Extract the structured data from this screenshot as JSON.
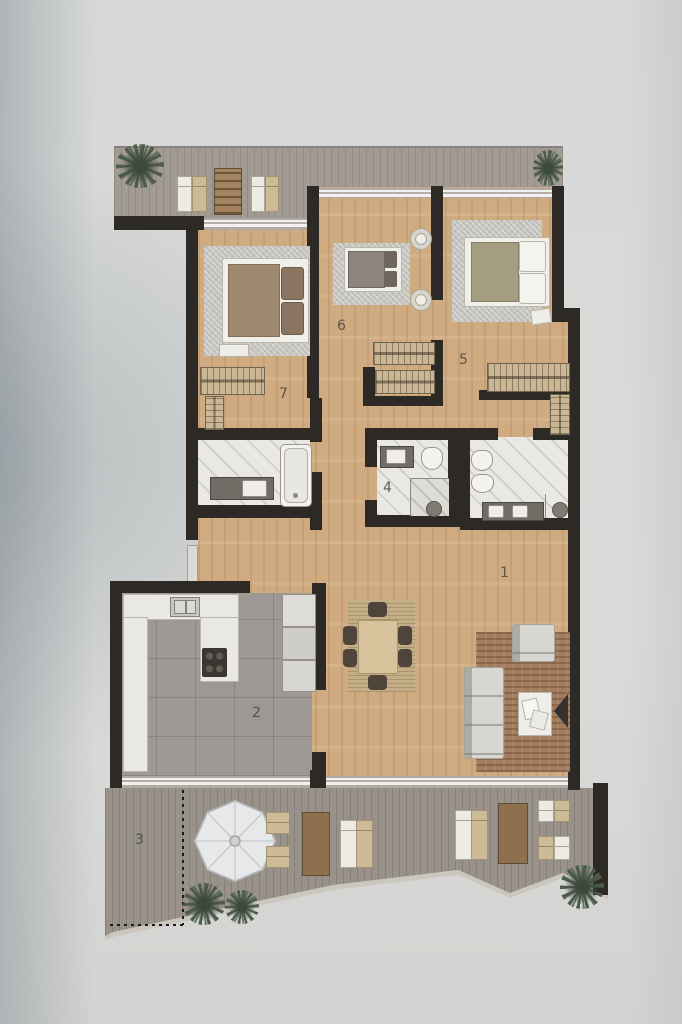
{
  "plan": {
    "rooms": [
      {
        "number": "1",
        "icons": [
          "sofa-icon",
          "armchair-icon",
          "coffee-table-icon",
          "tv-icon",
          "dining-table-icon",
          "dining-chairs-icon",
          "area-rug-icon",
          "jute-rug-icon"
        ]
      },
      {
        "number": "2",
        "icons": [
          "kitchen-counter-icon",
          "kitchen-sink-icon",
          "cooktop-icon",
          "fridge-icon",
          "oven-icon"
        ]
      },
      {
        "number": "3",
        "icons": [
          "parasol-icon",
          "sun-lounger-icon",
          "outdoor-table-icon",
          "seat-cushion-icon",
          "palm-plant-icon",
          "boundary-dotted-icon"
        ]
      },
      {
        "number": "4",
        "icons": [
          "washbasin-icon",
          "toilet-icon",
          "shower-icon"
        ]
      },
      {
        "number": "5",
        "icons": [
          "double-bed-icon",
          "bedroom-rug-icon",
          "wardrobe-icon",
          "nightstand-icon"
        ]
      },
      {
        "number": "6",
        "icons": [
          "double-bed-icon",
          "bedroom-rug-icon",
          "pouf-icon"
        ]
      },
      {
        "number": "7",
        "icons": [
          "double-bed-icon",
          "bedroom-rug-icon",
          "wardrobe-icon",
          "bed-bench-icon"
        ]
      }
    ],
    "unlabeled_areas": [
      {
        "name": "top terrace",
        "icons": [
          "palm-plant-icon",
          "sun-lounger-icon",
          "outdoor-table-icon"
        ]
      },
      {
        "name": "bathroom left",
        "icons": [
          "bathtub-icon",
          "washbasin-icon"
        ]
      },
      {
        "name": "bathroom right",
        "icons": [
          "toilet-icon",
          "bidet-icon",
          "double-washbasin-icon",
          "shower-icon"
        ]
      }
    ],
    "colors": {
      "wall": "#2d2a26",
      "wood_floor": "#d0ab81",
      "terrace_deck": "#a29b93",
      "lower_terrace_deck": "#99928a",
      "kitchen_tile": "#9c9995",
      "bathroom_marble": "#e9e8e3",
      "bedroom_rug": "#c6c4bf",
      "living_rug": "#a37d5f",
      "plant_green": "#4c5c4a",
      "background_paper": "#d7d9d8"
    }
  }
}
